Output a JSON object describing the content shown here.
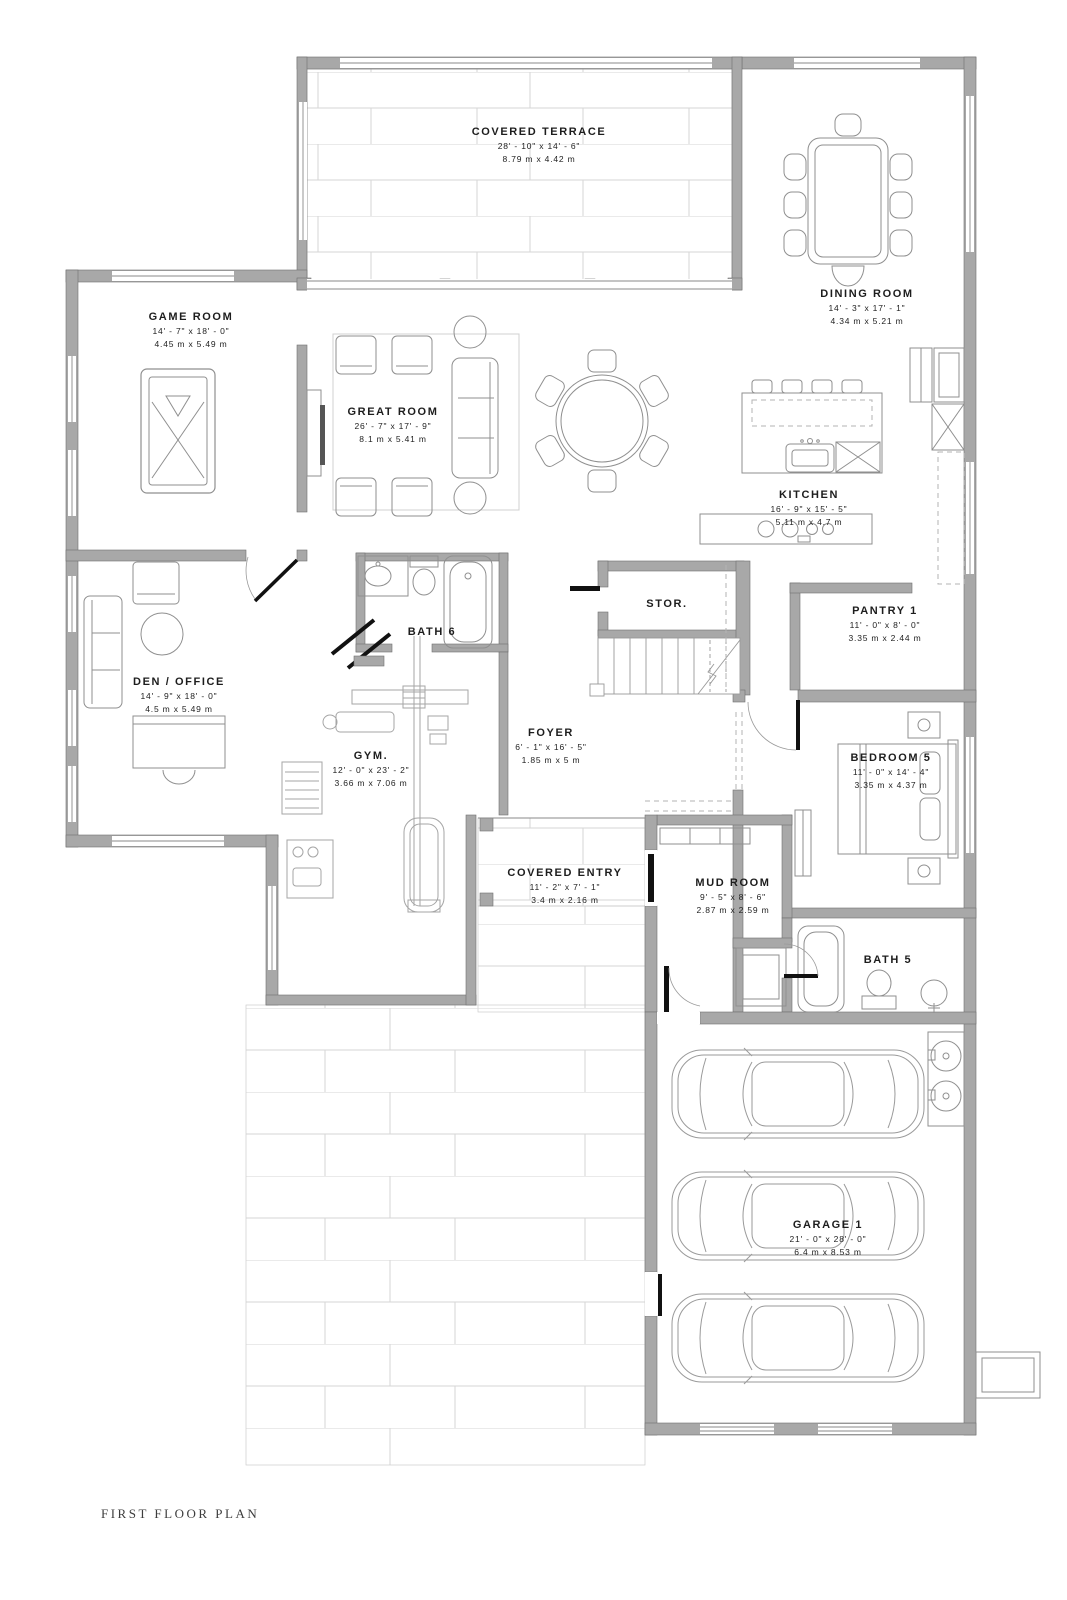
{
  "document": {
    "type": "architectural floor plan",
    "footer": {
      "title": "FIRST FLOOR PLAN"
    }
  },
  "palette": {
    "wall_gray": "#a8a8a8",
    "wall_edge": "#707070",
    "furniture_line": "#8f8f8f",
    "brick_line": "#d6d6d6",
    "door_black": "#111111",
    "text_black": "#1d1d1d"
  },
  "rooms": [
    {
      "id": "covered-terrace",
      "name": "COVERED TERRACE",
      "imperial": "28' - 10\" x 14' - 6\"",
      "metric": "8.79 m x 4.42 m"
    },
    {
      "id": "dining-room",
      "name": "DINING ROOM",
      "imperial": "14' - 3\" x 17' - 1\"",
      "metric": "4.34 m x 5.21 m"
    },
    {
      "id": "game-room",
      "name": "GAME ROOM",
      "imperial": "14' - 7\" x 18' - 0\"",
      "metric": "4.45 m x 5.49 m"
    },
    {
      "id": "great-room",
      "name": "GREAT ROOM",
      "imperial": "26' - 7\" x 17' - 9\"",
      "metric": "8.1 m x 5.41 m"
    },
    {
      "id": "kitchen",
      "name": "KITCHEN",
      "imperial": "16' - 9\" x 15' - 5\"",
      "metric": "5.11 m x 4.7 m"
    },
    {
      "id": "storage",
      "name": "STOR."
    },
    {
      "id": "pantry-1",
      "name": "PANTRY 1",
      "imperial": "11' - 0\" x 8' - 0\"",
      "metric": "3.35 m x 2.44 m"
    },
    {
      "id": "bath-6",
      "name": "BATH 6"
    },
    {
      "id": "den-office",
      "name": "DEN / OFFICE",
      "imperial": "14' - 9\" x 18' - 0\"",
      "metric": "4.5 m x 5.49 m"
    },
    {
      "id": "gym",
      "name": "GYM.",
      "imperial": "12' - 0\" x 23' - 2\"",
      "metric": "3.66 m x 7.06 m"
    },
    {
      "id": "foyer",
      "name": "FOYER",
      "imperial": "6' - 1\" x 16' - 5\"",
      "metric": "1.85 m x 5 m"
    },
    {
      "id": "bedroom-5",
      "name": "BEDROOM 5",
      "imperial": "11' - 0\" x 14' - 4\"",
      "metric": "3.35 m x 4.37 m"
    },
    {
      "id": "covered-entry",
      "name": "COVERED ENTRY",
      "imperial": "11' - 2\" x 7' - 1\"",
      "metric": "3.4 m x 2.16 m"
    },
    {
      "id": "mud-room",
      "name": "MUD ROOM",
      "imperial": "9' - 5\" x 8' - 6\"",
      "metric": "2.87 m x 2.59 m"
    },
    {
      "id": "bath-5",
      "name": "BATH 5"
    },
    {
      "id": "garage-1",
      "name": "GARAGE 1",
      "imperial": "21' - 0\" x 28' - 0\"",
      "metric": "6.4 m x 8.53 m"
    }
  ]
}
